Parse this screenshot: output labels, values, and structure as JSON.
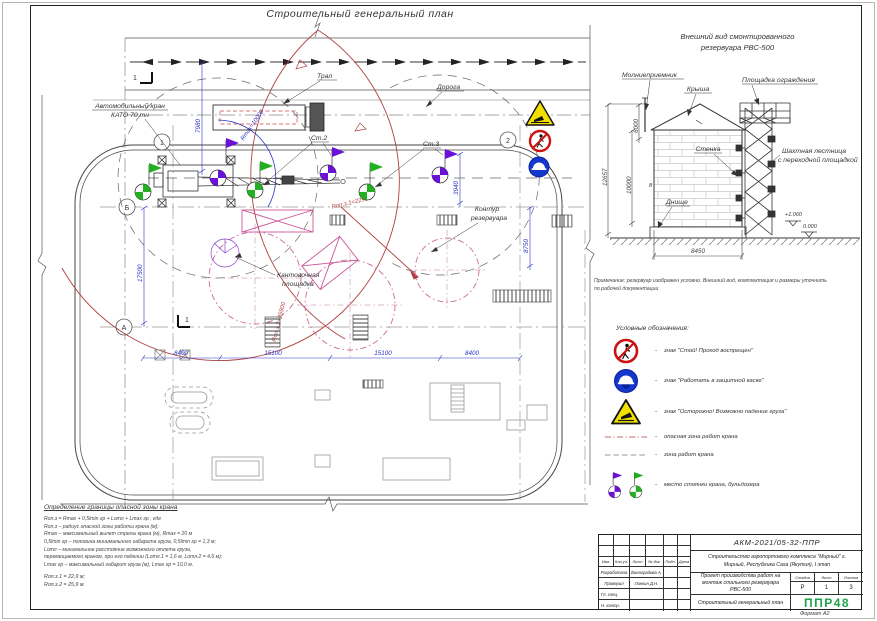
{
  "main_title": "Строительный генеральный план",
  "format_label": "Формат А2",
  "colors": {
    "dim_blue": "#2b35c0",
    "danger_red": "#b04040",
    "flag_purple": "#6a10d8",
    "flag_green": "#22b022",
    "pink": "#cc5599",
    "sign_red": "#cc1111",
    "sign_blue": "#1538cc",
    "sign_yellow": "#f2df00",
    "logo_green": "#1fa348"
  },
  "plan": {
    "road_label": "Дорога",
    "tral_label": "Трал",
    "crane_label_1": "Автомобильный кран",
    "crane_label_2": "КАТО 70 тн",
    "st2_label": "Ст.2",
    "st3_label": "Ст.3",
    "tank_contour_1": "Контур",
    "tank_contour_2": "резервуара",
    "kant_1": "Кантовочная",
    "kant_2": "площадка",
    "r_max_label": "Rmax=10000",
    "r_op1_label": "Rоп.з.1=22900",
    "r_op2_label": "Rоп.з.2=25900",
    "dim_7980": "7980",
    "dim_17500": "17500",
    "dim_8400_a": "8400",
    "dim_15100_a": "15100",
    "dim_15100_b": "15100",
    "dim_8400_b": "8400",
    "dim_3940": "3940",
    "dim_8750": "8750",
    "axis_1": "1",
    "axis_2": "2",
    "axis_a": "А",
    "axis_b": "Б",
    "section_mark": "1"
  },
  "elevation": {
    "title_1": "Внешний вид смонтированного",
    "title_2": "резервуара РВС-500",
    "lightning_rod": "Молниеприемник",
    "roof": "Крыша",
    "platform": "Площадка ограждения",
    "wall": "Стенка",
    "ladder_1": "Шахтная лестница",
    "ladder_2": "с переходной площадкой",
    "bottom": "Днище",
    "mark_8": "8",
    "dim_6000": "6000",
    "dim_10000": "10000",
    "dim_12657": "12657",
    "dim_8450": "8450",
    "level_high": "+1.060",
    "level_zero": "0.000",
    "note_1": "Примечание: резервуар изображен условно. Внешний вид, комплектация и размеры уточнить",
    "note_2": "по рабочей документации"
  },
  "legend": {
    "title": "Условные обозначения:",
    "dash": "-",
    "items": [
      {
        "label": "знак \"Стой! Проход воспрещен\""
      },
      {
        "label": "знак \"Работать в защитной каске\""
      },
      {
        "label": "знак \"Осторожно! Возможно падение груза\""
      },
      {
        "label": "опасная зона работ крана"
      },
      {
        "label": "зона работ крана"
      },
      {
        "label": "место стоянки крана, бульдозера"
      }
    ]
  },
  "danger_zone": {
    "title": "Определение границы опасной зоны крана",
    "lines": [
      "Rоп.з = Rmax + 0,5lmin гр + Lотл + Lmax гр , где",
      "Rоп.з – радиус опасной зоны работы крана (м);",
      "Rmax – максимальный вылет стрелы крана (м), Rmax = 20 м",
      "0,5lmin гр – половина минимального габарита груза, 0,5lmin гр = 1,3 м;",
      "Lотл – минимальное расстояние возможного отлета груза,",
      "перемещаемого краном, при его падении (Lотл.1 = 1,6 м, Lотл.2 = 4,6 м);",
      "Lmax гр – максимальный габарит груза (м), Lmax гр = 10,0 м."
    ],
    "results": [
      "Rоп.з.1 = 22,9 м;",
      "Rоп.з.2 = 25,9 м."
    ]
  },
  "stamp": {
    "doc_number": "АКМ-2021/05-32-ППР",
    "project": "Строительство аэропортового комплекса \"Мирный\" г. Мирный, Республика Саха (Якутия), I этап",
    "work_title": "Проект производства работ на монтаж стального резервуара РВС-500",
    "sheet_title": "Строительный генеральный план",
    "stage_label": "Стадия",
    "sheet_label": "Лист",
    "sheets_label": "Листов",
    "stage": "Р",
    "sheet": "1",
    "sheets": "3",
    "logo": "ППР48",
    "cols": [
      "Изм.",
      "Кол.уч.",
      "Лист",
      "№ док.",
      "Подп.",
      "Дата"
    ],
    "rows": [
      {
        "role": "Разработала",
        "name": "Виноградова А."
      },
      {
        "role": "Проверил",
        "name": "Линкин Д.Н."
      },
      {
        "role": "Гл. спец.",
        "name": ""
      },
      {
        "role": "Н. контр.",
        "name": ""
      }
    ]
  }
}
